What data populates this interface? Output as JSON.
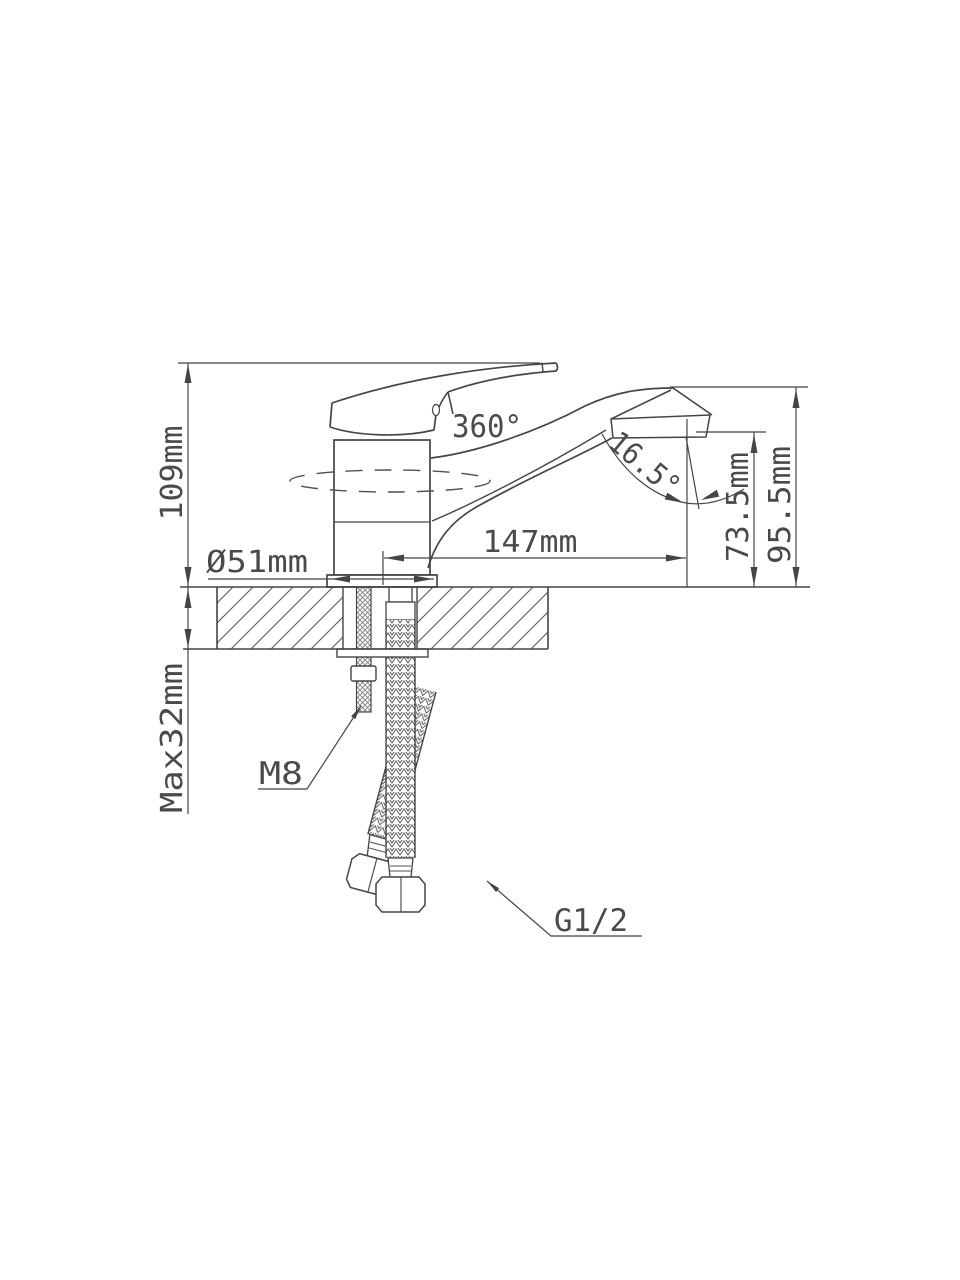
{
  "diagram": {
    "type": "technical-drawing",
    "subject": "single-lever basin mixer faucet installation dimensions",
    "colors": {
      "line": "#454545",
      "text": "#4a4a4a",
      "background": "#ffffff"
    },
    "labels": {
      "total_height": "109mm",
      "swivel_angle": "360°",
      "spout_reach": "147mm",
      "spout_tilt_angle": "16.5°",
      "outlet_height": "73.5mm",
      "spout_top_height": "95.5mm",
      "base_diameter": "Ø51mm",
      "max_mount_thickness": "Max32mm",
      "stud_thread": "M8",
      "hose_connection_thread": "G1/2"
    }
  }
}
